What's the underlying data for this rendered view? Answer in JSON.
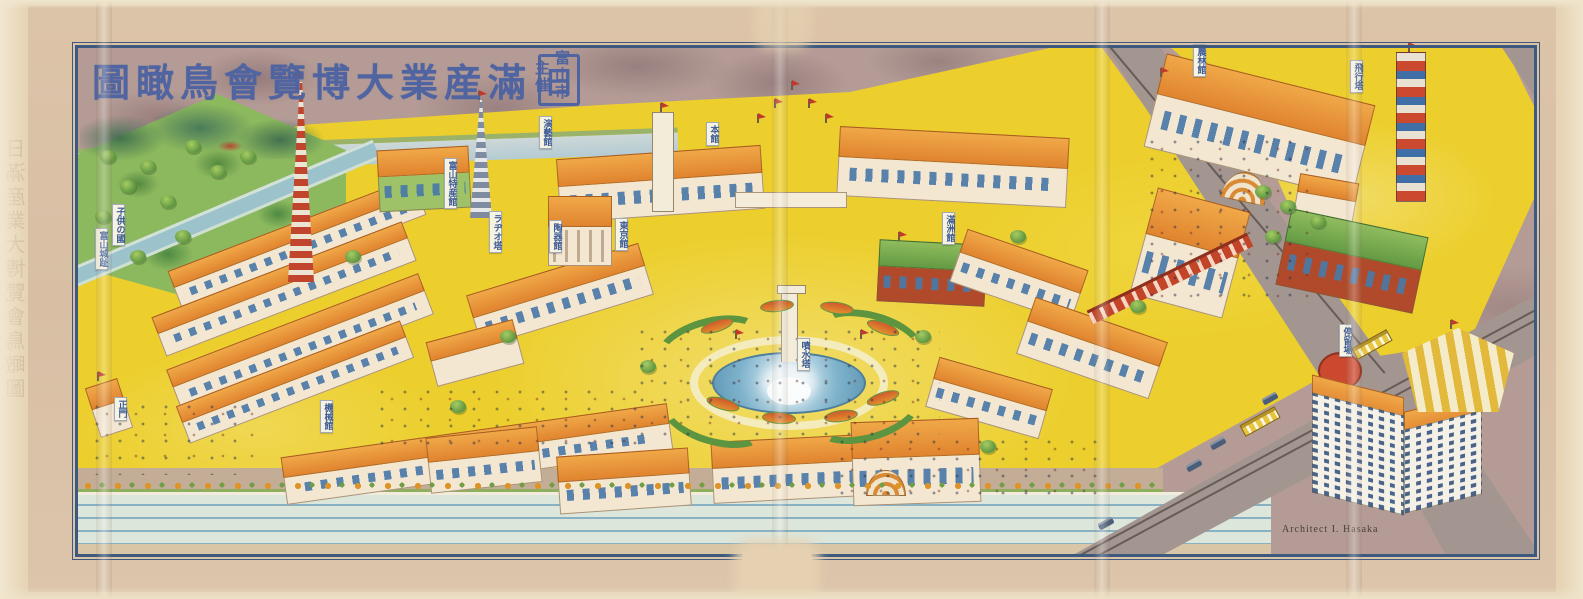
{
  "artwork": {
    "title": "日滿産業大博覽會鳥瞰圖",
    "title_display": "圖瞰鳥會覽博大業産滿",
    "title_last": "日",
    "organizer": "富山市主催",
    "organizer_line1": "富山市",
    "organizer_line2": "主催",
    "signature": "Architect I. Hasaka",
    "ghost_margin_text": "日滿産業大博覽會鳥瞰圖"
  },
  "map": {
    "labels": [
      {
        "text": "子供の國",
        "x": 112,
        "y": 204
      },
      {
        "text": "富山城趾",
        "x": 95,
        "y": 228
      },
      {
        "text": "富山特産館",
        "x": 444,
        "y": 158
      },
      {
        "text": "ラヂオ塔",
        "x": 489,
        "y": 211
      },
      {
        "text": "演藝館",
        "x": 539,
        "y": 116
      },
      {
        "text": "本館",
        "x": 706,
        "y": 122
      },
      {
        "text": "陶器館",
        "x": 549,
        "y": 220
      },
      {
        "text": "東京館",
        "x": 615,
        "y": 218
      },
      {
        "text": "滿洲館",
        "x": 942,
        "y": 212
      },
      {
        "text": "噴水塔",
        "x": 797,
        "y": 338
      },
      {
        "text": "機械館",
        "x": 320,
        "y": 400
      },
      {
        "text": "正門",
        "x": 114,
        "y": 397
      },
      {
        "text": "農林館",
        "x": 1193,
        "y": 44
      },
      {
        "text": "飛行塔",
        "x": 1350,
        "y": 60
      },
      {
        "text": "停留場",
        "x": 1339,
        "y": 324
      }
    ]
  },
  "colors": {
    "frame": "#3d5a7e",
    "title": "#4f64a0",
    "ground": "#eccf2d",
    "roof": "#e0842f",
    "wall": "#f4e7d1",
    "water": "#8fb9c8",
    "road": "#a39590",
    "paper": "#e6d4b5",
    "sky": "#b49b95",
    "label-text": "#3b5a94",
    "brick": "#b04a2a",
    "tree": "#5d9440"
  }
}
